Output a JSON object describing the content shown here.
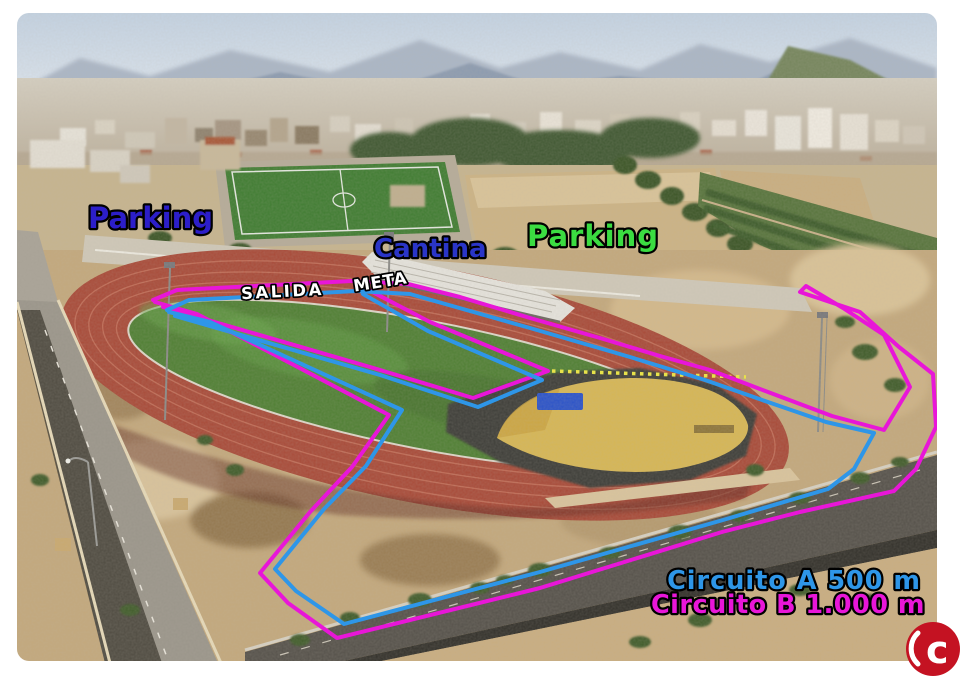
{
  "image": {
    "description": "Aerial photo of an athletics track complex with two marked training circuits",
    "salida_label": "SALIDA",
    "meta_label": "META"
  },
  "labels": {
    "parking_left": "Parking",
    "cantina": "Cantina",
    "parking_right": "Parking",
    "meta": "META",
    "salida": "SALIDA"
  },
  "legend": {
    "circuit_a": "Circuito A 500 m",
    "circuit_b": "Circuito B 1.000 m"
  },
  "colors": {
    "parking_left": "#2c1ec9",
    "cantina": "#2a35c8",
    "parking_right": "#3bdc41",
    "meta": "#ffffff",
    "salida": "#ffffff",
    "circuit_a": "#2e96e8",
    "circuit_b": "#e816d8",
    "connector_dots": "#e8e24a",
    "logo_red": "#c41222",
    "logo_glyph_color": "#ffffff"
  },
  "logo": {
    "glyph": "c"
  }
}
